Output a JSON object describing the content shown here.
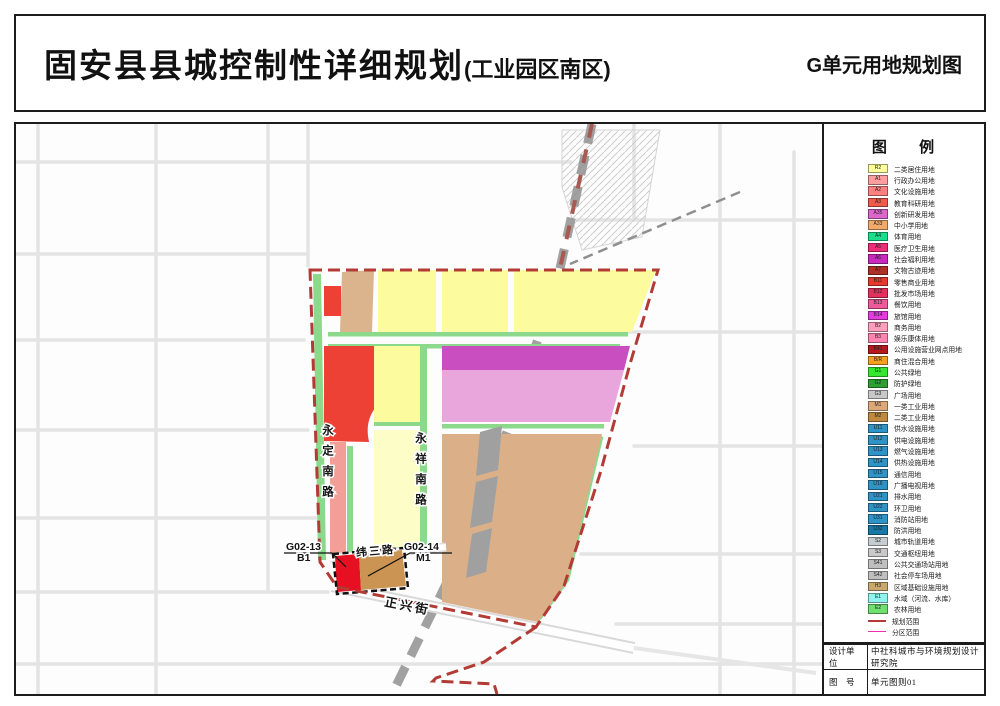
{
  "page": {
    "title": "固安县县城控制性详细规划",
    "title_suffix": "(工业园区南区)",
    "sheet_title": "G单元用地规划图"
  },
  "map": {
    "road_labels": {
      "yongding": "永定南路",
      "yongxiang": "永祥南路",
      "weisan": "纬三路",
      "zhengxing": "正兴街"
    },
    "parcel_labels": {
      "g0213_code": "G02-13",
      "g0213_use": "B1",
      "g0214_code": "G02-14",
      "g0214_use": "M1"
    }
  },
  "legend": {
    "title": "图 例",
    "items": [
      {
        "type": "swatch",
        "code": "R2",
        "color": "#FDFD9B",
        "label": "二类居住用地"
      },
      {
        "type": "swatch",
        "code": "A1",
        "color": "#FF9E9E",
        "label": "行政办公用地"
      },
      {
        "type": "swatch",
        "code": "A2",
        "color": "#FF8080",
        "label": "文化设施用地"
      },
      {
        "type": "swatch",
        "code": "A3",
        "color": "#F05A4A",
        "label": "教育科研用地"
      },
      {
        "type": "swatch",
        "code": "A35",
        "color": "#DD66CC",
        "label": "创新研发用地"
      },
      {
        "type": "swatch",
        "code": "A33",
        "color": "#F2AA6B",
        "label": "中小学用地"
      },
      {
        "type": "swatch",
        "code": "A4",
        "color": "#17DF8C",
        "label": "体育用地"
      },
      {
        "type": "swatch",
        "code": "A5",
        "color": "#EE2C77",
        "label": "医疗卫生用地"
      },
      {
        "type": "swatch",
        "code": "A6",
        "color": "#C929BF",
        "label": "社会福利用地"
      },
      {
        "type": "swatch",
        "code": "A7",
        "color": "#B03026",
        "label": "文物古迹用地"
      },
      {
        "type": "swatch",
        "code": "B11",
        "color": "#E8372C",
        "label": "零售商业用地"
      },
      {
        "type": "swatch",
        "code": "B12",
        "color": "#E3315E",
        "label": "批发市场用地"
      },
      {
        "type": "swatch",
        "code": "B13",
        "color": "#F05A9B",
        "label": "餐饮用地"
      },
      {
        "type": "swatch",
        "code": "B14",
        "color": "#E23BE2",
        "label": "旅馆用地"
      },
      {
        "type": "swatch",
        "code": "B2",
        "color": "#FF9FBE",
        "label": "商务用地"
      },
      {
        "type": "swatch",
        "code": "B3",
        "color": "#FF85B0",
        "label": "娱乐康体用地"
      },
      {
        "type": "swatch",
        "code": "B41",
        "color": "#B5191E",
        "label": "公用设施营业网点用地"
      },
      {
        "type": "swatch",
        "code": "B/R",
        "color": "#F5A11F",
        "label": "商住混合用地"
      },
      {
        "type": "swatch",
        "code": "G1",
        "color": "#35E82F",
        "label": "公共绿地"
      },
      {
        "type": "swatch",
        "code": "G2",
        "color": "#2F9E32",
        "label": "防护绿地"
      },
      {
        "type": "swatch",
        "code": "G3",
        "color": "#C8C8C8",
        "label": "广场用地"
      },
      {
        "type": "swatch",
        "code": "M1",
        "color": "#DCA878",
        "label": "一类工业用地"
      },
      {
        "type": "swatch",
        "code": "M2",
        "color": "#C08A3E",
        "label": "二类工业用地"
      },
      {
        "type": "swatch",
        "code": "U11",
        "color": "#2E93C6",
        "label": "供水设施用地"
      },
      {
        "type": "swatch",
        "code": "U12",
        "color": "#2E93C6",
        "label": "供电设施用地"
      },
      {
        "type": "swatch",
        "code": "U13",
        "color": "#2E93C6",
        "label": "燃气设施用地"
      },
      {
        "type": "swatch",
        "code": "U14",
        "color": "#2E93C6",
        "label": "供热设施用地"
      },
      {
        "type": "swatch",
        "code": "U15",
        "color": "#2E93C6",
        "label": "通信用地"
      },
      {
        "type": "swatch",
        "code": "U16",
        "color": "#2E93C6",
        "label": "广播电视用地"
      },
      {
        "type": "swatch",
        "code": "U21",
        "color": "#2E93C6",
        "label": "排水用地"
      },
      {
        "type": "swatch",
        "code": "U22",
        "color": "#2E93C6",
        "label": "环卫用地"
      },
      {
        "type": "swatch",
        "code": "U31",
        "color": "#2E93C6",
        "label": "消防站用地"
      },
      {
        "type": "swatch",
        "code": "U32",
        "color": "#1679A8",
        "label": "防洪用地"
      },
      {
        "type": "swatch",
        "code": "S2",
        "color": "#C6CDD2",
        "label": "城市轨道用地"
      },
      {
        "type": "swatch",
        "code": "S3",
        "color": "#C9C9C9",
        "label": "交通枢纽用地"
      },
      {
        "type": "swatch",
        "code": "S41",
        "color": "#BFBFBF",
        "label": "公共交通场站用地"
      },
      {
        "type": "swatch",
        "code": "S42",
        "color": "#BFBFBF",
        "label": "社会停车场用地"
      },
      {
        "type": "swatch",
        "code": "H3",
        "color": "#C9A96E",
        "label": "区域基础设施用地"
      },
      {
        "type": "swatch",
        "code": "E1",
        "color": "#8FF3F0",
        "label": "水域（河流、水库）"
      },
      {
        "type": "swatch",
        "code": "E2",
        "color": "#6FE06F",
        "label": "农林用地"
      },
      {
        "type": "line",
        "color": "#B43A3A",
        "label": "规划范围"
      },
      {
        "type": "line",
        "color": "#EE2DB0",
        "label": "分区范围"
      }
    ]
  },
  "titleblock": {
    "design_label": "设计单位",
    "design_value": "中社科城市与环境规划设计研究院",
    "number_label": "图　号",
    "number_value": "单元图则01"
  }
}
